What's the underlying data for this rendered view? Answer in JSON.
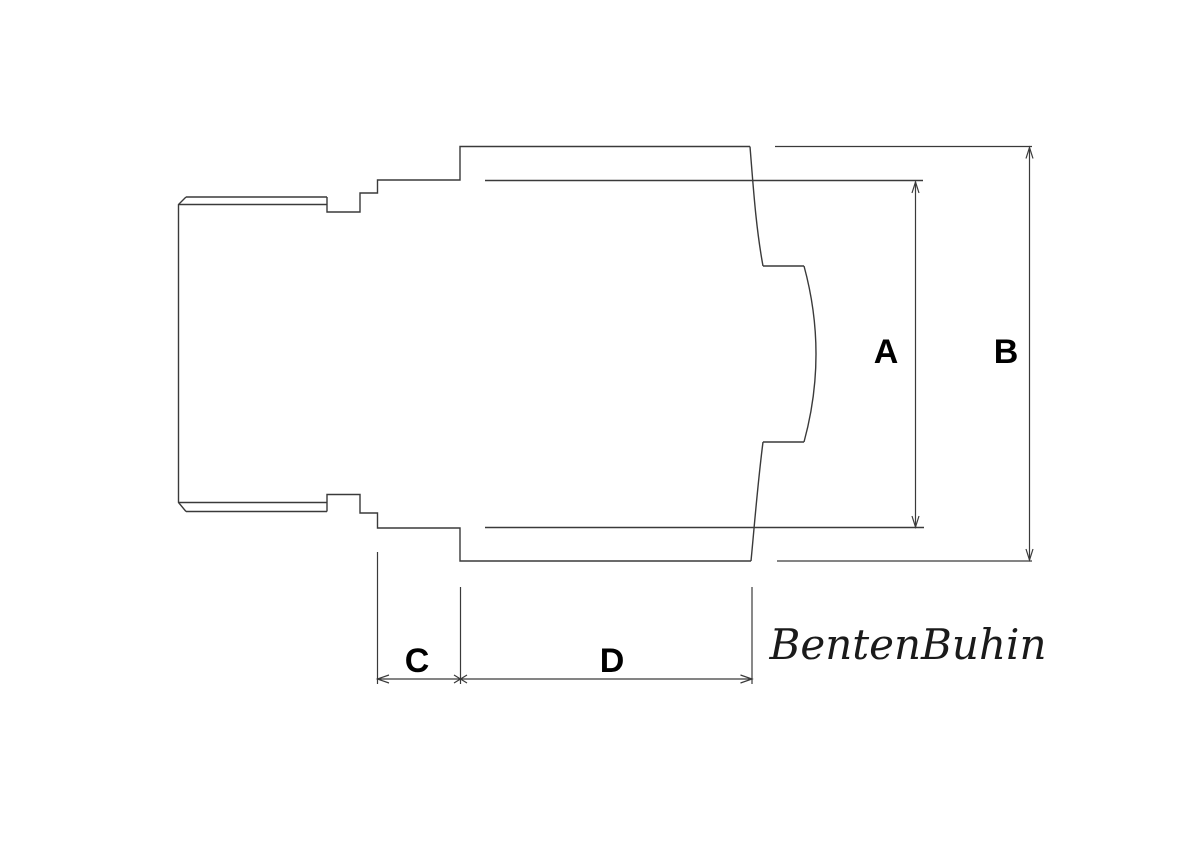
{
  "page": {
    "background": "#ffffff"
  },
  "drawing": {
    "line_color": "#3a3a3a",
    "label_color": "#000000",
    "dimensions": {
      "a": "A",
      "b": "B",
      "c": "C",
      "d": "D"
    },
    "watermark": "BentenBuhin"
  }
}
